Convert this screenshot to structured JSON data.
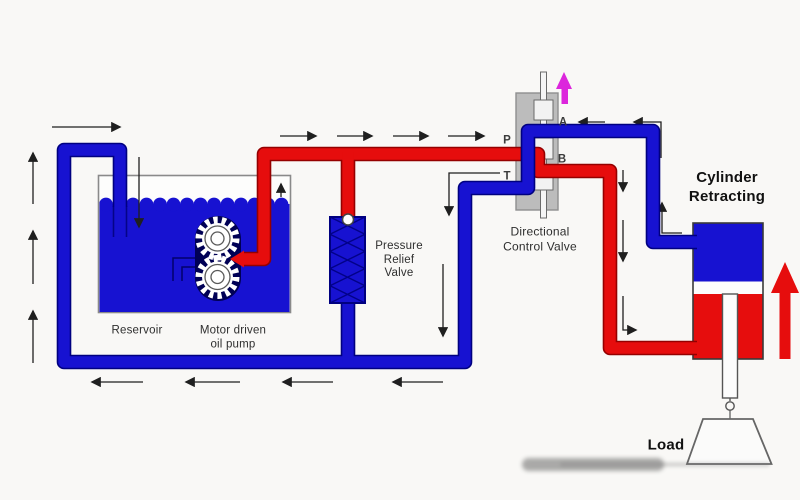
{
  "labels": {
    "reservoir": "Reservoir",
    "pump_line1": "Motor driven",
    "pump_line2": "oil pump",
    "relief_line1": "Pressure",
    "relief_line2": "Relief",
    "relief_line3": "Valve",
    "dcv_line1": "Directional",
    "dcv_line2": "Control Valve",
    "cylinder_line1": "Cylinder",
    "cylinder_line2": "Retracting",
    "load": "Load",
    "port_p": "P",
    "port_t": "T",
    "port_a": "A",
    "port_b": "B"
  },
  "colors": {
    "oil_blue": "#1712d1",
    "oil_blue_dark": "#000080",
    "pressure_red": "#e60d0d",
    "pressure_red_dark": "#950000",
    "valve_gray": "#bcbcbc",
    "magenta": "#dc26dc",
    "annotation": "#1f1f1f",
    "background": "#f9f8f6"
  }
}
